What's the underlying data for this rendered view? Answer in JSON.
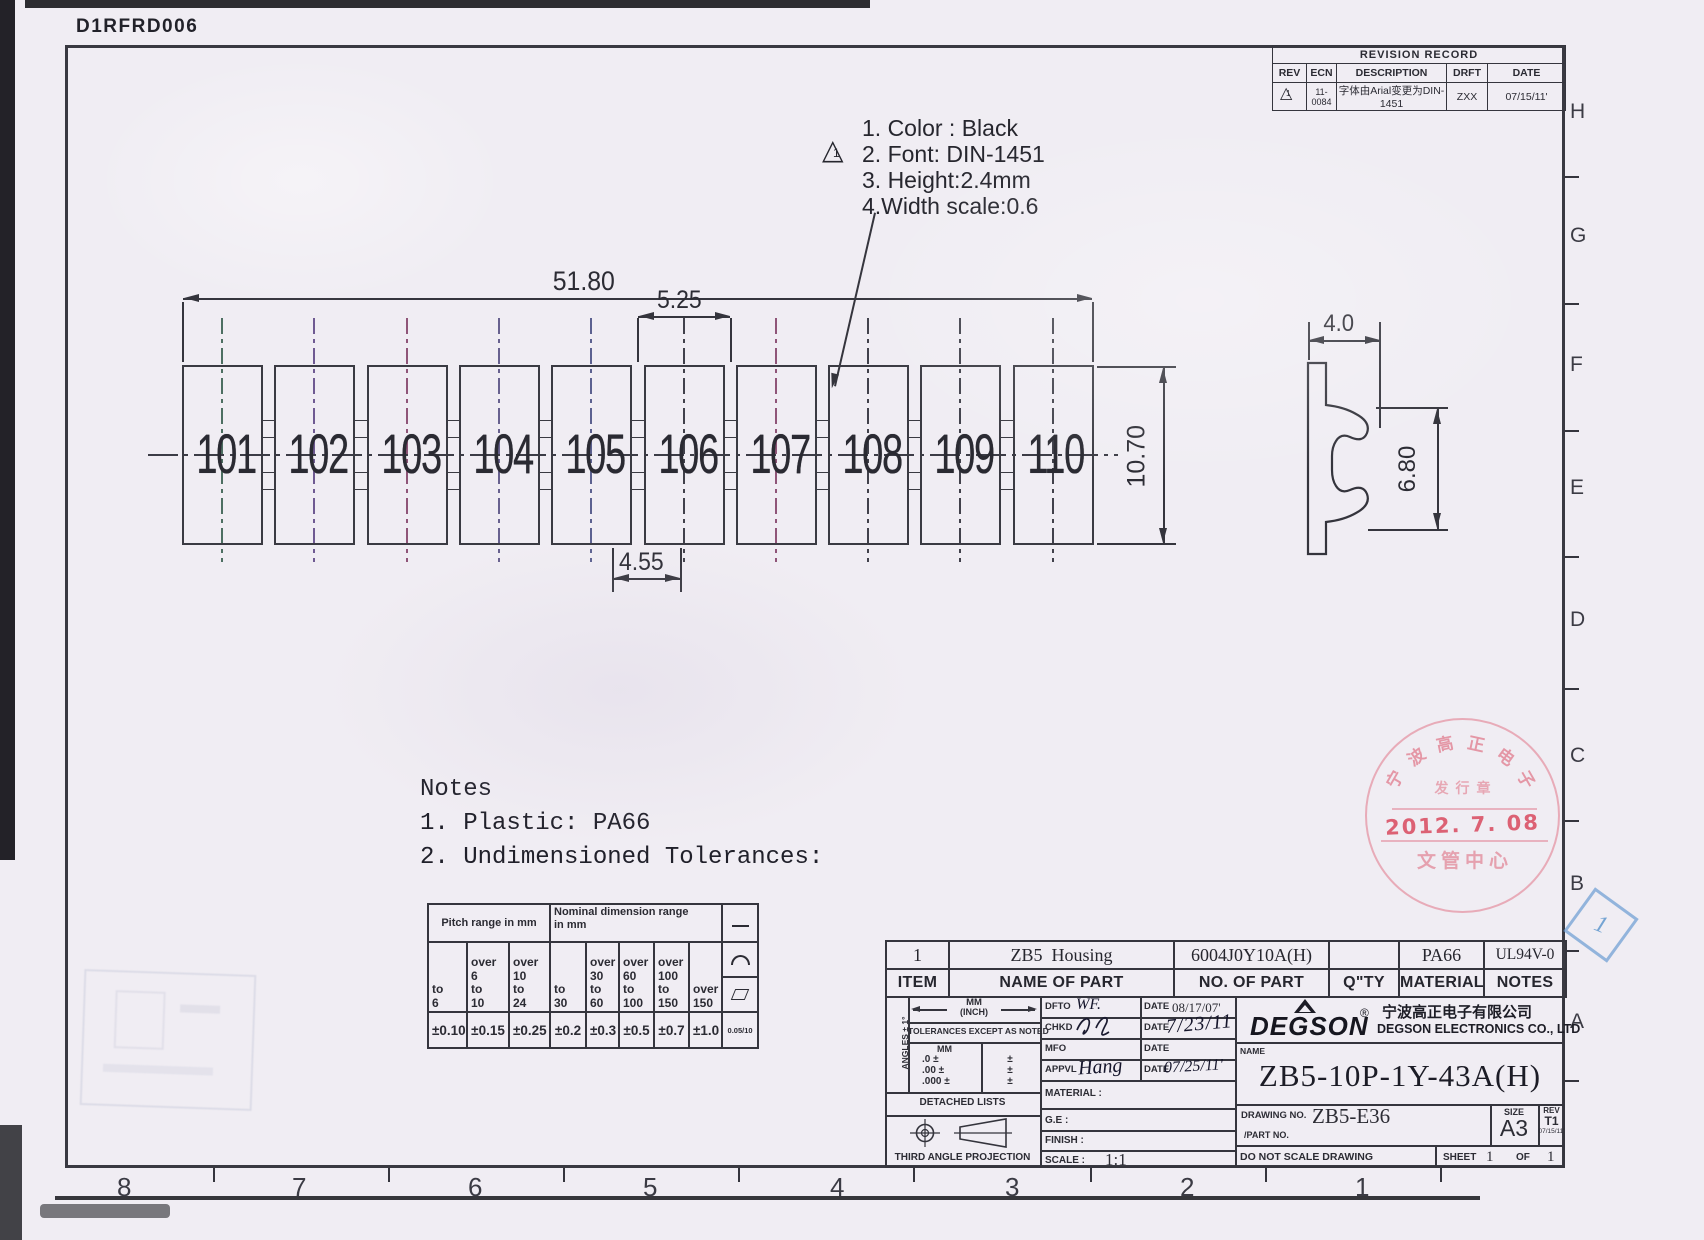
{
  "page": {
    "doc_code": "D1RFRD006"
  },
  "zones": {
    "rows": [
      "H",
      "G",
      "F",
      "E",
      "D",
      "C",
      "B",
      "A"
    ],
    "cols": [
      "8",
      "7",
      "6",
      "5",
      "4",
      "3",
      "2",
      "1"
    ]
  },
  "revision": {
    "title": "REVISION RECORD",
    "h_rev": "REV",
    "h_ecn": "ECN",
    "h_desc": "DESCRIPTION",
    "h_drft": "DRFT",
    "h_date": "DATE",
    "rev": "1",
    "ecn": "11-0084",
    "desc": "字体由Arial变更为DIN-1451",
    "drft": "ZXX",
    "date": "07/15/11'"
  },
  "callout": {
    "flag": "1",
    "l1": "1. Color : Black",
    "l2": "2. Font: DIN-1451",
    "l3": "3. Height:2.4mm",
    "l4": "4.Width scale:0.6"
  },
  "strip": {
    "cells": [
      "101",
      "102",
      "103",
      "104",
      "105",
      "106",
      "107",
      "108",
      "109",
      "110"
    ]
  },
  "dims": {
    "overall": "51.80",
    "pitch": "5.25",
    "cellw": "4.55",
    "height": "10.70",
    "side_w": "4.0",
    "side_h": "6.80"
  },
  "notes": {
    "title": "Notes",
    "n1": "1. Plastic: PA66",
    "n2": "2. Undimensioned Tolerances:"
  },
  "tol": {
    "pitch_header": "Pitch range in mm",
    "nominal_header": "Nominal dimension range\nin mm",
    "ranges": [
      "to\n6",
      "over\n6\nto\n10",
      "over\n10\nto\n24",
      "to\n30",
      "over\n30\nto\n60",
      "over\n60\nto\n100",
      "over\n100\nto\n150",
      "over\n150"
    ],
    "values": [
      "±0.10",
      "±0.15",
      "±0.25",
      "±0.2",
      "±0.3",
      "±0.5",
      "±0.7",
      "±1.0"
    ],
    "flat_value": "0.05/10",
    "icons": {
      "straightness": "—",
      "arc": "⌒",
      "flatness": "▱"
    }
  },
  "parts": {
    "item": "1",
    "name": "ZB5  Housing",
    "no": "6004J0Y10A(H)",
    "qty": "",
    "material": "PA66",
    "notes": "UL94V-0",
    "h_item": "ITEM",
    "h_name": "NAME OF PART",
    "h_no": "NO. OF PART",
    "h_qty": "Q\"TY",
    "h_material": "MATERIAL",
    "h_notes": "NOTES"
  },
  "tb": {
    "angles": "ANGLES ± 1°",
    "mm": "MM",
    "inch": "(INCH)",
    "tol_note": "TOLERANCES EXCEPT AS NOTED",
    "mm_label": "MM",
    "r1": ".0 ±",
    "r2": ".00 ±",
    "r3": ".000 ±",
    "p1": "±",
    "p2": "±",
    "p3": "±",
    "detached": "DETACHED LISTS",
    "projection": "THIRD ANGLE PROJECTION",
    "dfto_l": "DFTO",
    "dfto": "WF.",
    "date_l1": "DATE",
    "date1": "08/17/07'",
    "chkd_l": "CHKD",
    "date_l2": "DATE",
    "date2": "7/23/11",
    "mfo_l": "MFO",
    "date_l3": "DATE",
    "appvl_l": "APPVL",
    "appvl": "Hang",
    "date_l4": "DATE",
    "date4": "07/25/11'",
    "material_l": "MATERIAL :",
    "ge_l": "G.E :",
    "finish_l": "FINISH :",
    "scale_l": "SCALE :",
    "scale": "1:1",
    "logo": "DEGSON",
    "reg": "®",
    "company_cn": "宁波高正电子有限公司",
    "company_en": "DEGSON ELECTRONICS CO., LTD",
    "name_l": "NAME",
    "part_name": "ZB5-10P-1Y-43A(H)",
    "drawing_no_l": "DRAWING NO.",
    "drawing_no": "ZB5-E36",
    "part_no_l": "/PART  NO.",
    "size_l": "SIZE",
    "size": "A3",
    "rev_l": "REV",
    "rev": "T1",
    "rev_date": "07/15/11'",
    "no_scale": "DO NOT SCALE DRAWING",
    "sheet_l": "SHEET",
    "sheet": "1",
    "of_l": "OF",
    "of": "1"
  },
  "stamp": {
    "arc": [
      "宁",
      "波",
      "高",
      "正",
      "电",
      "子"
    ],
    "line2": "发行章",
    "date": "2012. 7. 08",
    "bottom": "文管中心"
  },
  "blue_tag": {
    "label": "1"
  }
}
